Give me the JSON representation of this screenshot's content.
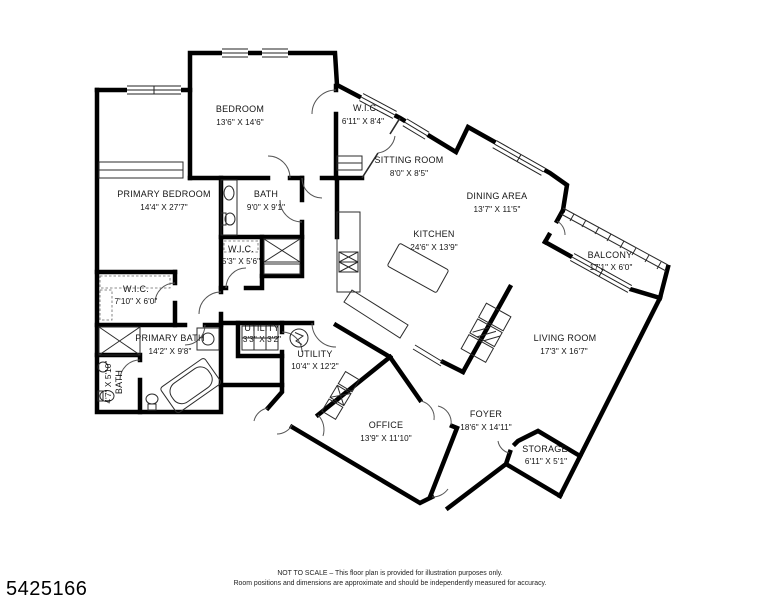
{
  "rooms": [
    {
      "name": "PRIMARY BEDROOM",
      "dims": "14'4\" X 27'7\""
    },
    {
      "name": "BEDROOM",
      "dims": "13'6\" X 14'6\""
    },
    {
      "name": "W.I.C.",
      "dims": "6'11\" X 8'4\""
    },
    {
      "name": "SITTING ROOM",
      "dims": "8'0\" X 8'5\""
    },
    {
      "name": "BATH",
      "dims": "9'0\" X 9'1\""
    },
    {
      "name": "W.I.C.",
      "dims": "5'3\" X 5'6\""
    },
    {
      "name": "DINING AREA",
      "dims": "13'7\" X 11'5\""
    },
    {
      "name": "KITCHEN",
      "dims": "24'6\" X 13'9\""
    },
    {
      "name": "BALCONY",
      "dims": "17'1\" X 6'0\""
    },
    {
      "name": "LIVING ROOM",
      "dims": "17'3\" X 16'7\""
    },
    {
      "name": "W.I.C.",
      "dims": "7'10\" X 6'0\""
    },
    {
      "name": "PRIMARY BATH",
      "dims": "14'2\" X 9'8\""
    },
    {
      "name": "BATH",
      "dims": "4'7\" X 5'10\""
    },
    {
      "name": "UTILITY",
      "dims": "3'3\" X 3'2\""
    },
    {
      "name": "UTILITY",
      "dims": "10'4\" X 12'2\""
    },
    {
      "name": "OFFICE",
      "dims": "13'9\" X 11'10\""
    },
    {
      "name": "FOYER",
      "dims": "18'6\" X 14'11\""
    },
    {
      "name": "STORAGE",
      "dims": "6'11\" X 5'1\""
    }
  ],
  "footer": {
    "listing_id": "5425166",
    "line1": "NOT TO SCALE – This floor plan is provided for illustration purposes only.",
    "line2": "Room positions and dimensions are approximate and should be independently measured for accuracy."
  }
}
